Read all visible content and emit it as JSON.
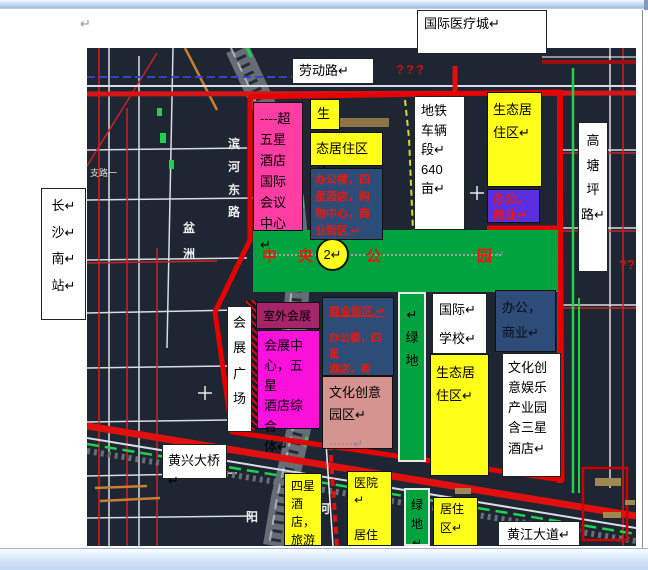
{
  "page": {
    "pilcrow": "↵"
  },
  "colors": {
    "magenta_box": "#ff3da2",
    "fuchsia_box": "#fb10dc",
    "maroon_box": "#a6246a",
    "yellow_box": "#ffff19",
    "blue_box": "#2d4d78",
    "purple_box": "#5b2ee0",
    "park_green": "#00a33e",
    "pink_box": "#d69490",
    "red_text": "#e8190f",
    "road_red": "#e01010",
    "map_bg": "#1f2633"
  },
  "white_boxes": {
    "intl_medical": "国际医疗城↵",
    "laodong_road": "劳动路↵",
    "changsha_south": "长↵\n沙↵\n南↵\n站↵",
    "gaotangping_road": "高\n塘\n坪\n路↵",
    "metro_depot": "地铁\n车辆\n段↵\n640\n亩↵",
    "expo_plaza": "会\n展\n广\n场",
    "intl_school": "国际↵\n学校↵",
    "cultural_industry": "文化创\n意娱乐\n产业园\n含三星\n酒店↵",
    "huangxing_bridge": "黄兴大桥↵",
    "huangjiang_ave": "黄江大道↵"
  },
  "zones": {
    "super_hotel": "----超\n五星\n酒店\n国际\n会议\n中心↵",
    "sheng": "生↵",
    "eco_strip": "态居住区↵",
    "mixed_blue_top": "办公楼，四\n星酒店，购\n物中心，商\n业街区.↵",
    "eco_top_right": "生态居\n住区↵",
    "office_purple": "办公，\n商业↵",
    "outdoor_expo": "室外会展↵",
    "expo_center": "会展中\n心，五星\n酒店综合\n体↵",
    "biz_street": "商业街区.↵",
    "mixed_blue_mid": "办公楼，四星\n酒店，商场.↵",
    "cultural_creative": "文化创意\n园区↵",
    "cultural_creative_dots": "⋯⋯↵",
    "green_mid": "↵\n绿\n地",
    "eco_mid_right": "生态居\n住区↵",
    "office_blue": "办公，\n商业↵",
    "four_star_hotel": "四星\n酒\n店，\n旅游",
    "hospital_resident": "医院↵\n\n居住\n区↵",
    "green_bottom": "绿\n地↵",
    "resident_bottom": "居住\n区↵"
  },
  "park": {
    "c1": "中",
    "c2": "央",
    "c3": "公",
    "c4": "园",
    "badge": "2↵",
    "tail": "↵"
  },
  "map_labels": {
    "q_top": "???",
    "q_right": "??",
    "binhe_road": "滨\n河\n东\n路",
    "penzhou": "盆\n洲",
    "taiping": "太平小区",
    "zhilu": "支路一",
    "yang": "阳",
    "he": "河"
  }
}
